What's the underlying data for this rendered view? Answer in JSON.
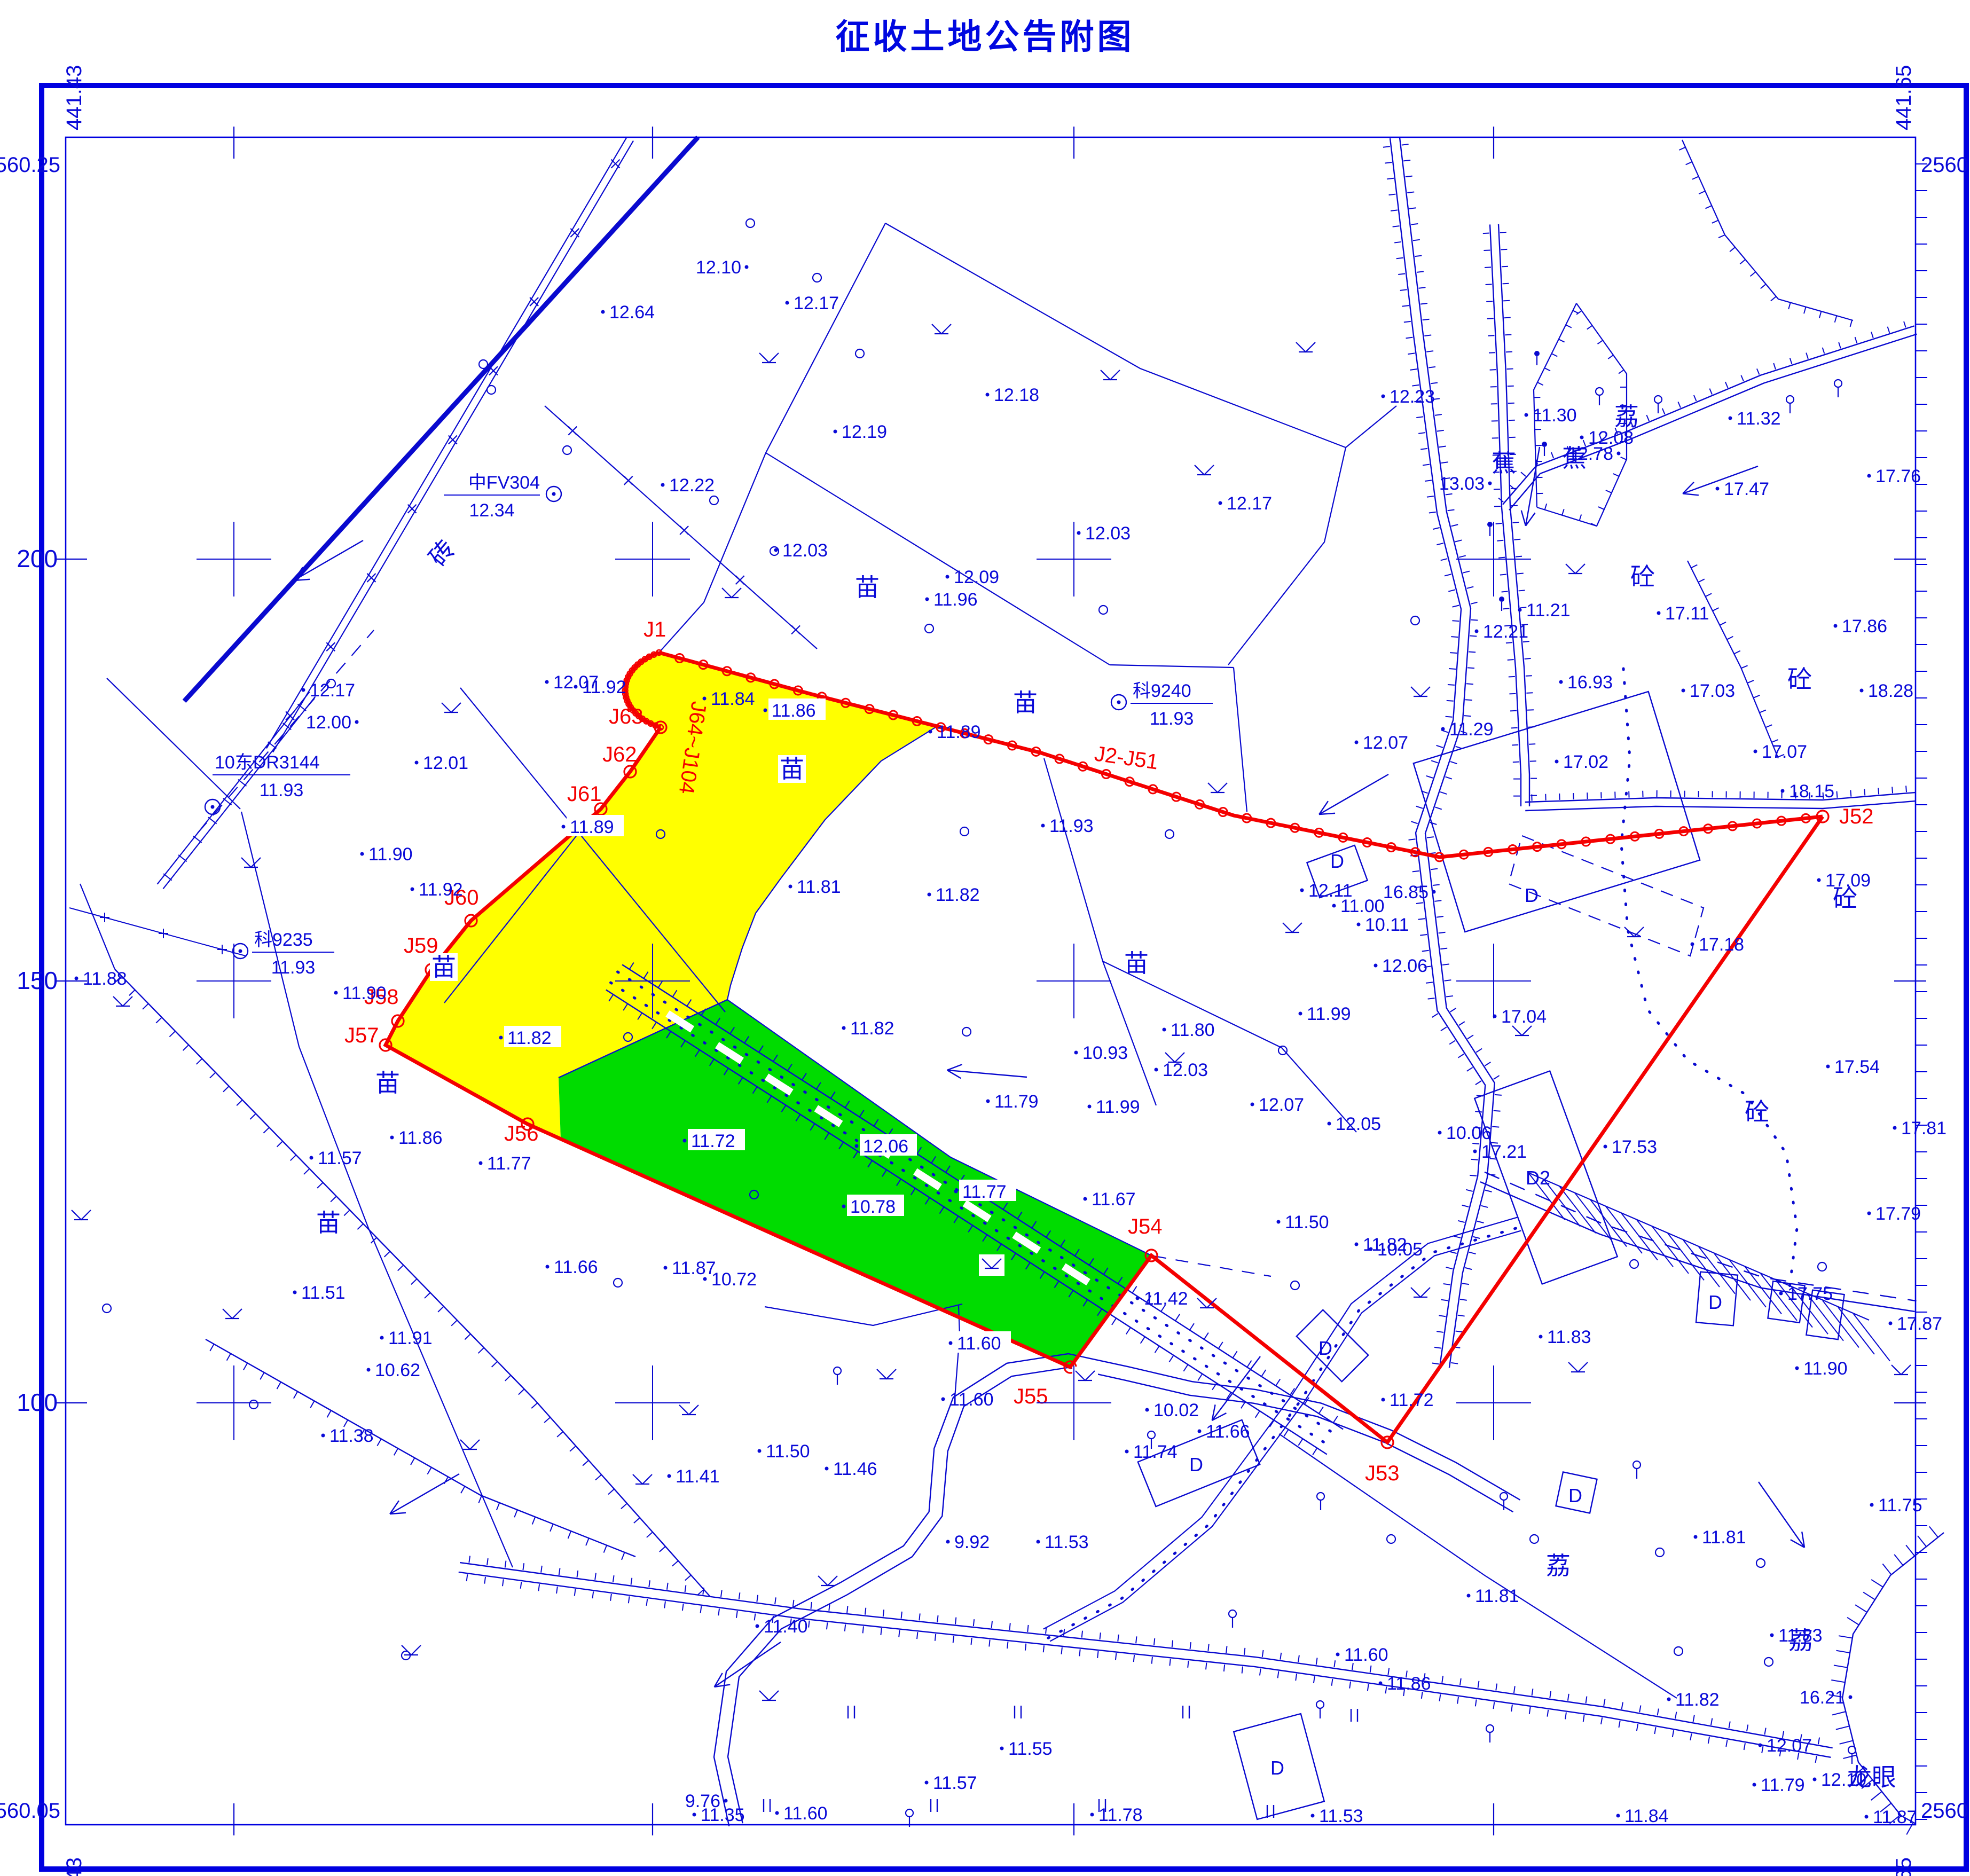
{
  "title": "征收土地公告附图",
  "colors": {
    "blue": "#0909cf",
    "text_blue": "#0a0ad8",
    "red": "#f40000",
    "yellow": "#ffff00",
    "green": "#00dc00",
    "white": "#ffffff"
  },
  "frame": {
    "corners": {
      "top_left_n": "2560.25",
      "top_left_e": "441.43",
      "top_right_n": "2560.25",
      "top_right_e": "441.65",
      "bottom_left_n": "2560.05",
      "bottom_left_e": "441.43",
      "bottom_right_n": "2560.05",
      "bottom_right_e": "441.65"
    },
    "x_ticks": [
      {
        "x": 438,
        "label": "450"
      },
      {
        "x": 1222,
        "label": "500"
      },
      {
        "x": 2011,
        "label": "550"
      },
      {
        "x": 2797,
        "label": "600"
      }
    ],
    "y_ticks": [
      {
        "y": 1047,
        "label": "200"
      },
      {
        "y": 1837,
        "label": "150"
      },
      {
        "y": 2627,
        "label": "100"
      }
    ]
  },
  "boundary": {
    "vertex_labels": [
      {
        "x": 1205,
        "y": 1192,
        "t": "J1"
      },
      {
        "x": 1140,
        "y": 1355,
        "t": "J63"
      },
      {
        "x": 1128,
        "y": 1426,
        "t": "J62"
      },
      {
        "x": 1062,
        "y": 1500,
        "t": "J61"
      },
      {
        "x": 832,
        "y": 1694,
        "t": "J60"
      },
      {
        "x": 756,
        "y": 1784,
        "t": "J59"
      },
      {
        "x": 682,
        "y": 1880,
        "t": "J58"
      },
      {
        "x": 645,
        "y": 1952,
        "t": "J57"
      },
      {
        "x": 944,
        "y": 2136,
        "t": "J56"
      },
      {
        "x": 1898,
        "y": 2628,
        "t": "J55"
      },
      {
        "x": 2112,
        "y": 2310,
        "t": "J54"
      },
      {
        "x": 2556,
        "y": 2772,
        "t": "J53"
      },
      {
        "x": 3444,
        "y": 1542,
        "t": "J52"
      }
    ],
    "range_labels": [
      {
        "x": 2048,
        "y": 1424,
        "t": "J2-J51",
        "rot": 8
      },
      {
        "x": 1296,
        "y": 1312,
        "t": "J64~J104",
        "rot": 98
      }
    ]
  },
  "control_points": [
    {
      "x": 1037,
      "y": 925,
      "name": "中FV304",
      "elev": "12.34",
      "side": "left"
    },
    {
      "x": 2095,
      "y": 1315,
      "name": "科9240",
      "elev": "11.93",
      "side": "right"
    },
    {
      "x": 398,
      "y": 1511,
      "name": "10东DR3144",
      "elev": "11.93",
      "side": "above"
    },
    {
      "x": 450,
      "y": 1781,
      "name": "科9235",
      "elev": "11.93",
      "side": "right"
    }
  ],
  "spot_heights": [
    [
      1398,
      500,
      "12.10",
      "L"
    ],
    [
      1474,
      567,
      "12.17"
    ],
    [
      1129,
      584,
      "12.64"
    ],
    [
      1849,
      739,
      "12.18"
    ],
    [
      1564,
      808,
      "12.19"
    ],
    [
      2590,
      742,
      "12.23"
    ],
    [
      1241,
      908,
      "12.22"
    ],
    [
      1453,
      1030,
      "12.03"
    ],
    [
      1774,
      1080,
      "12.09"
    ],
    [
      2285,
      942,
      "12.17"
    ],
    [
      1319,
      1308,
      "11.84"
    ],
    [
      1736,
      1122,
      "11.96"
    ],
    [
      1024,
      1277,
      "12.07"
    ],
    [
      668,
      1352,
      "12.00",
      "L"
    ],
    [
      568,
      1292,
      "12.17"
    ],
    [
      780,
      1428,
      "12.01"
    ],
    [
      2020,
      998,
      "12.03"
    ],
    [
      2765,
      1182,
      "12.21"
    ],
    [
      2540,
      1390,
      "12.07"
    ],
    [
      1078,
      1286,
      "11.92"
    ],
    [
      1433,
      1330,
      "11.86",
      "w"
    ],
    [
      1742,
      1370,
      "11.89"
    ],
    [
      1953,
      1546,
      "11.93"
    ],
    [
      678,
      1599,
      "11.90"
    ],
    [
      772,
      1665,
      "11.92"
    ],
    [
      629,
      1859,
      "11.90"
    ],
    [
      143,
      1832,
      "11.88"
    ],
    [
      583,
      2168,
      "11.57"
    ],
    [
      734,
      2130,
      "11.86"
    ],
    [
      900,
      2178,
      "11.77"
    ],
    [
      552,
      2420,
      "11.51"
    ],
    [
      715,
      2505,
      "11.91"
    ],
    [
      690,
      2565,
      "10.62"
    ],
    [
      1025,
      2372,
      "11.66"
    ],
    [
      1246,
      2374,
      "11.87"
    ],
    [
      1320,
      2395,
      "10.72"
    ],
    [
      605,
      2688,
      "11.38"
    ],
    [
      1253,
      2764,
      "11.41"
    ],
    [
      1548,
      2750,
      "11.46"
    ],
    [
      1055,
      1548,
      "11.89",
      "w"
    ],
    [
      938,
      1943,
      "11.82",
      "w"
    ],
    [
      1480,
      1660,
      "11.81",
      "w"
    ],
    [
      1580,
      1925,
      "11.82"
    ],
    [
      1740,
      1675,
      "11.82"
    ],
    [
      2180,
      1928,
      "11.80"
    ],
    [
      2435,
      1898,
      "11.99"
    ],
    [
      2015,
      1971,
      "10.93"
    ],
    [
      1850,
      2062,
      "11.79"
    ],
    [
      2040,
      2072,
      "11.99"
    ],
    [
      2165,
      2003,
      "12.03"
    ],
    [
      2345,
      2068,
      "12.07"
    ],
    [
      2489,
      2104,
      "12.05"
    ],
    [
      1282,
      2136,
      "11.72",
      "w"
    ],
    [
      1604,
      2146,
      "12.06",
      "w"
    ],
    [
      1580,
      2259,
      "10.78",
      "w"
    ],
    [
      1790,
      2231,
      "11.77",
      "w"
    ],
    [
      1780,
      2515,
      "11.60",
      "w"
    ],
    [
      2032,
      2245,
      "11.67"
    ],
    [
      2540,
      2330,
      "11.82"
    ],
    [
      2394,
      2288,
      "11.50"
    ],
    [
      2567,
      2339,
      "10.05"
    ],
    [
      2696,
      2121,
      "10.06"
    ],
    [
      2130,
      2431,
      "11.42"
    ],
    [
      2110,
      2718,
      "11.74"
    ],
    [
      2148,
      2640,
      "10.02"
    ],
    [
      2246,
      2680,
      "11.66"
    ],
    [
      2590,
      2621,
      "11.72"
    ],
    [
      2885,
      2503,
      "11.83"
    ],
    [
      2762,
      2156,
      "17.21"
    ],
    [
      3365,
      2562,
      "11.90"
    ],
    [
      2790,
      905,
      "13.03",
      "L"
    ],
    [
      2858,
      777,
      "11.30"
    ],
    [
      2962,
      819,
      "12.08"
    ],
    [
      3031,
      849,
      "12.78",
      "L"
    ],
    [
      3240,
      783,
      "11.32"
    ],
    [
      3216,
      915,
      "17.47"
    ],
    [
      3500,
      891,
      "17.76"
    ],
    [
      2846,
      1142,
      "11.21"
    ],
    [
      3106,
      1148,
      "17.11"
    ],
    [
      2923,
      1277,
      "16.93"
    ],
    [
      3437,
      1172,
      "17.86"
    ],
    [
      3287,
      1407,
      "17.07"
    ],
    [
      3152,
      1293,
      "17.03"
    ],
    [
      2915,
      1426,
      "17.02"
    ],
    [
      3486,
      1293,
      "18.28"
    ],
    [
      3338,
      1481,
      "18.15"
    ],
    [
      3406,
      1648,
      "17.09"
    ],
    [
      3169,
      1768,
      "17.18"
    ],
    [
      3423,
      1997,
      "17.54"
    ],
    [
      2685,
      1670,
      "16.85",
      "L"
    ],
    [
      2702,
      1365,
      "11.29"
    ],
    [
      2438,
      1667,
      "12.11"
    ],
    [
      2576,
      1808,
      "12.06"
    ],
    [
      2498,
      1696,
      "11.00"
    ],
    [
      2544,
      1731,
      "10.11"
    ],
    [
      2799,
      1903,
      "17.04"
    ],
    [
      3006,
      2147,
      "17.53"
    ],
    [
      3548,
      2112,
      "17.81"
    ],
    [
      3500,
      2272,
      "17.79"
    ],
    [
      3335,
      2422,
      "17.75"
    ],
    [
      3540,
      2478,
      "17.87"
    ],
    [
      3505,
      2818,
      "11.75"
    ],
    [
      3175,
      2878,
      "11.81"
    ],
    [
      2750,
      2988,
      "11.81"
    ],
    [
      3318,
      3062,
      "11.83"
    ],
    [
      3465,
      3178,
      "16.21",
      "L"
    ],
    [
      3125,
      3182,
      "11.82"
    ],
    [
      3296,
      3268,
      "12.07"
    ],
    [
      3285,
      3342,
      "11.79"
    ],
    [
      3398,
      3332,
      "12.10"
    ],
    [
      1766,
      2620,
      "11.60"
    ],
    [
      1422,
      2717,
      "11.50"
    ],
    [
      1775,
      2887,
      "9.92"
    ],
    [
      1944,
      2887,
      "11.53"
    ],
    [
      1418,
      3045,
      "11.40"
    ],
    [
      1735,
      3338,
      "11.57"
    ],
    [
      1876,
      3274,
      "11.55"
    ],
    [
      1359,
      3372,
      "9.76",
      "L"
    ],
    [
      1300,
      3398,
      "11.35"
    ],
    [
      1455,
      3395,
      "11.60"
    ],
    [
      2045,
      3398,
      "11.78"
    ],
    [
      2458,
      3400,
      "11.53"
    ],
    [
      2505,
      3098,
      "11.60"
    ],
    [
      2585,
      3152,
      "11.86"
    ],
    [
      3030,
      3400,
      "11.84"
    ],
    [
      3495,
      3402,
      "11.87"
    ]
  ],
  "area_labels": [
    {
      "x": 1624,
      "y": 1100,
      "t": "苗"
    },
    {
      "x": 1483,
      "y": 1440,
      "t": "苗",
      "w": 1
    },
    {
      "x": 1920,
      "y": 1316,
      "t": "苗"
    },
    {
      "x": 2128,
      "y": 1804,
      "t": "苗"
    },
    {
      "x": 831,
      "y": 1811,
      "t": "苗",
      "w": 1
    },
    {
      "x": 726,
      "y": 2028,
      "t": "苗"
    },
    {
      "x": 615,
      "y": 2290,
      "t": "苗"
    },
    {
      "x": 3046,
      "y": 780,
      "t": "荔"
    },
    {
      "x": 2918,
      "y": 2932,
      "t": "荔"
    },
    {
      "x": 3372,
      "y": 3072,
      "t": "荔"
    },
    {
      "x": 2948,
      "y": 858,
      "t": "蕉"
    },
    {
      "x": 2816,
      "y": 867,
      "t": "蕉"
    },
    {
      "x": 3076,
      "y": 1080,
      "t": "砼"
    },
    {
      "x": 3370,
      "y": 1272,
      "t": "砼"
    },
    {
      "x": 3455,
      "y": 1682,
      "t": "砼"
    },
    {
      "x": 3290,
      "y": 2082,
      "t": "砼"
    },
    {
      "x": 3505,
      "y": 3328,
      "t": "龙眼"
    },
    {
      "x": 840,
      "y": 1030,
      "t": "砖",
      "rot": -50
    }
  ],
  "building_labels": [
    {
      "x": 2868,
      "y": 1676,
      "t": "D"
    },
    {
      "x": 2880,
      "y": 2205,
      "t": "D2"
    },
    {
      "x": 2504,
      "y": 1612,
      "t": "D"
    },
    {
      "x": 2482,
      "y": 2524,
      "t": "D"
    },
    {
      "x": 2240,
      "y": 2742,
      "t": "D"
    },
    {
      "x": 3212,
      "y": 2438,
      "t": "D"
    },
    {
      "x": 2950,
      "y": 2800,
      "t": "D"
    },
    {
      "x": 2392,
      "y": 3310,
      "t": "D"
    }
  ],
  "symbols": {
    "trees": [
      [
        1405,
        418
      ],
      [
        1530,
        520
      ],
      [
        1610,
        662
      ],
      [
        905,
        682
      ],
      [
        1062,
        843
      ],
      [
        1337,
        937
      ],
      [
        1450,
        1032
      ],
      [
        1740,
        1177
      ],
      [
        2066,
        1142
      ],
      [
        2650,
        1162
      ],
      [
        1237,
        1562
      ],
      [
        1806,
        1557
      ],
      [
        2190,
        1562
      ],
      [
        1176,
        1942
      ],
      [
        1810,
        1932
      ],
      [
        2402,
        1967
      ],
      [
        1412,
        2237
      ],
      [
        1157,
        2402
      ],
      [
        2425,
        2407
      ],
      [
        3060,
        2367
      ],
      [
        3412,
        2372
      ],
      [
        2605,
        2882
      ],
      [
        2873,
        2882
      ],
      [
        3108,
        2907
      ],
      [
        3297,
        2927
      ],
      [
        3143,
        3092
      ],
      [
        3312,
        3112
      ],
      [
        920,
        730
      ],
      [
        620,
        1280
      ],
      [
        200,
        2450
      ],
      [
        760,
        3100
      ],
      [
        475,
        2630
      ]
    ],
    "stem_trees": [
      [
        2156,
        2687
      ],
      [
        2308,
        3022
      ],
      [
        1703,
        3395
      ],
      [
        3468,
        3277
      ],
      [
        2790,
        3237
      ],
      [
        2472,
        3192
      ],
      [
        3065,
        2743
      ],
      [
        2473,
        2802
      ],
      [
        2816,
        2802
      ],
      [
        1568,
        2567
      ],
      [
        2995,
        733
      ],
      [
        3105,
        748
      ],
      [
        3352,
        748
      ],
      [
        3442,
        718
      ]
    ],
    "banana": [
      [
        2878,
        662
      ],
      [
        2892,
        832
      ],
      [
        2790,
        982
      ],
      [
        2812,
        1122
      ]
    ],
    "grass": [
      [
        1763,
        621
      ],
      [
        1440,
        675
      ],
      [
        2079,
        707
      ],
      [
        2445,
        655
      ],
      [
        2255,
        885
      ],
      [
        2950,
        1070
      ],
      [
        1370,
        1115
      ],
      [
        845,
        1330
      ],
      [
        470,
        1620
      ],
      [
        230,
        1880
      ],
      [
        152,
        2280
      ],
      [
        435,
        2465
      ],
      [
        880,
        2710
      ],
      [
        1290,
        2645
      ],
      [
        1550,
        2965
      ],
      [
        770,
        3095
      ],
      [
        1440,
        3180
      ],
      [
        2260,
        2445
      ],
      [
        2660,
        2425
      ],
      [
        2850,
        1935
      ],
      [
        2280,
        1480
      ],
      [
        2660,
        1300
      ],
      [
        3060,
        1750
      ],
      [
        2955,
        2565
      ],
      [
        3560,
        2570
      ],
      [
        1203,
        2775
      ],
      [
        2200,
        1985
      ],
      [
        2420,
        1742
      ]
    ],
    "grass_boxed": [
      [
        1857,
        2371
      ],
      [
        1660,
        2578
      ],
      [
        2032,
        2581
      ]
    ],
    "paddy": [
      [
        1594,
        3206
      ],
      [
        1906,
        3206
      ],
      [
        2221,
        3206
      ],
      [
        2536,
        3212
      ],
      [
        1436,
        3381
      ],
      [
        1749,
        3381
      ],
      [
        2064,
        3381
      ],
      [
        2379,
        3392
      ]
    ]
  }
}
